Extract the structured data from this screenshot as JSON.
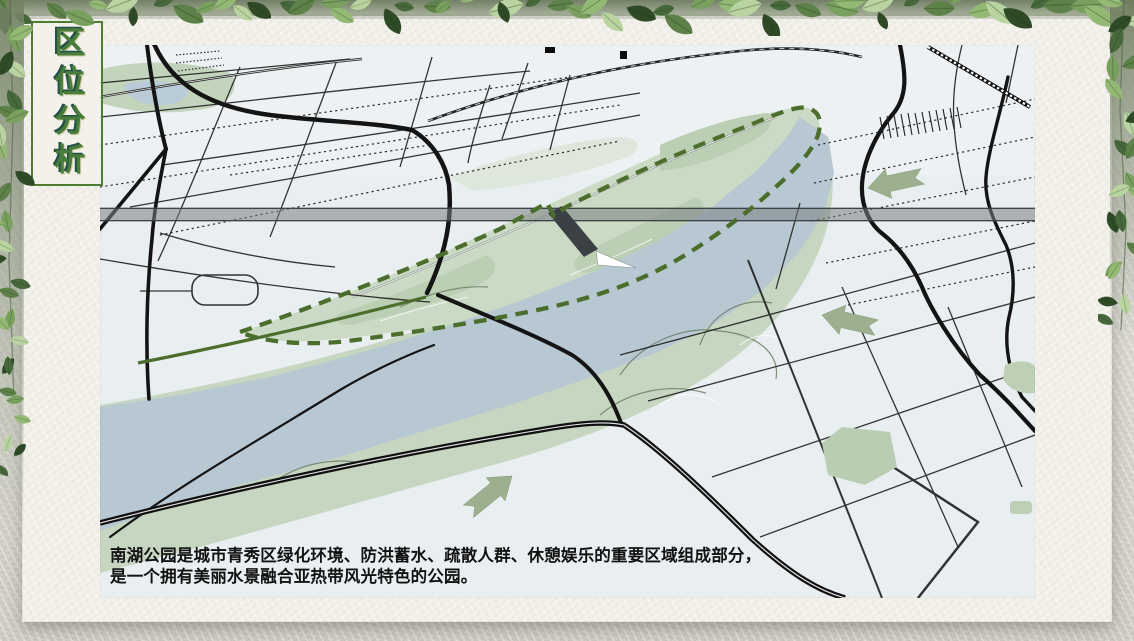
{
  "slide": {
    "title": "区位分析",
    "caption": {
      "line1": "南湖公园是城市青秀区绿化环境、防洪蓄水、疏散人群、休憩娱乐的重要区域组成部分，",
      "line2": "是一个拥有美丽水景融合亚热带风光特色的公园。"
    }
  },
  "map": {
    "kind": "perspective-city-map",
    "symbols": {
      "park_boundary": "dashed-green-outline",
      "arrows": [
        {
          "name": "flow-arrow-upper-west",
          "direction": "west"
        },
        {
          "name": "flow-arrow-lower-west",
          "direction": "west"
        },
        {
          "name": "flow-arrow-northeast",
          "direction": "northeast"
        }
      ]
    },
    "colors": {
      "map_bg": "#e9eef1",
      "river": "#b7c8d3",
      "park_green": "#cbdac5",
      "bank_green": "#c6d6c0",
      "boundary_green": "#4c6e2d",
      "arrow_green": "#9caf8e",
      "road_black": "#141414",
      "highway_grey": "#7a8084",
      "bridge_grey": "#3a4044"
    }
  },
  "theme": {
    "panel_bg": "#f1efe8",
    "outer_bg": "#d8d6ce",
    "title_green": "#4a7c3c",
    "title_border": "#4f7c33",
    "leaf_palette": [
      "#2e4a26",
      "#47683a",
      "#5d8148",
      "#79a05e",
      "#93b974",
      "#b9d4a0"
    ]
  }
}
